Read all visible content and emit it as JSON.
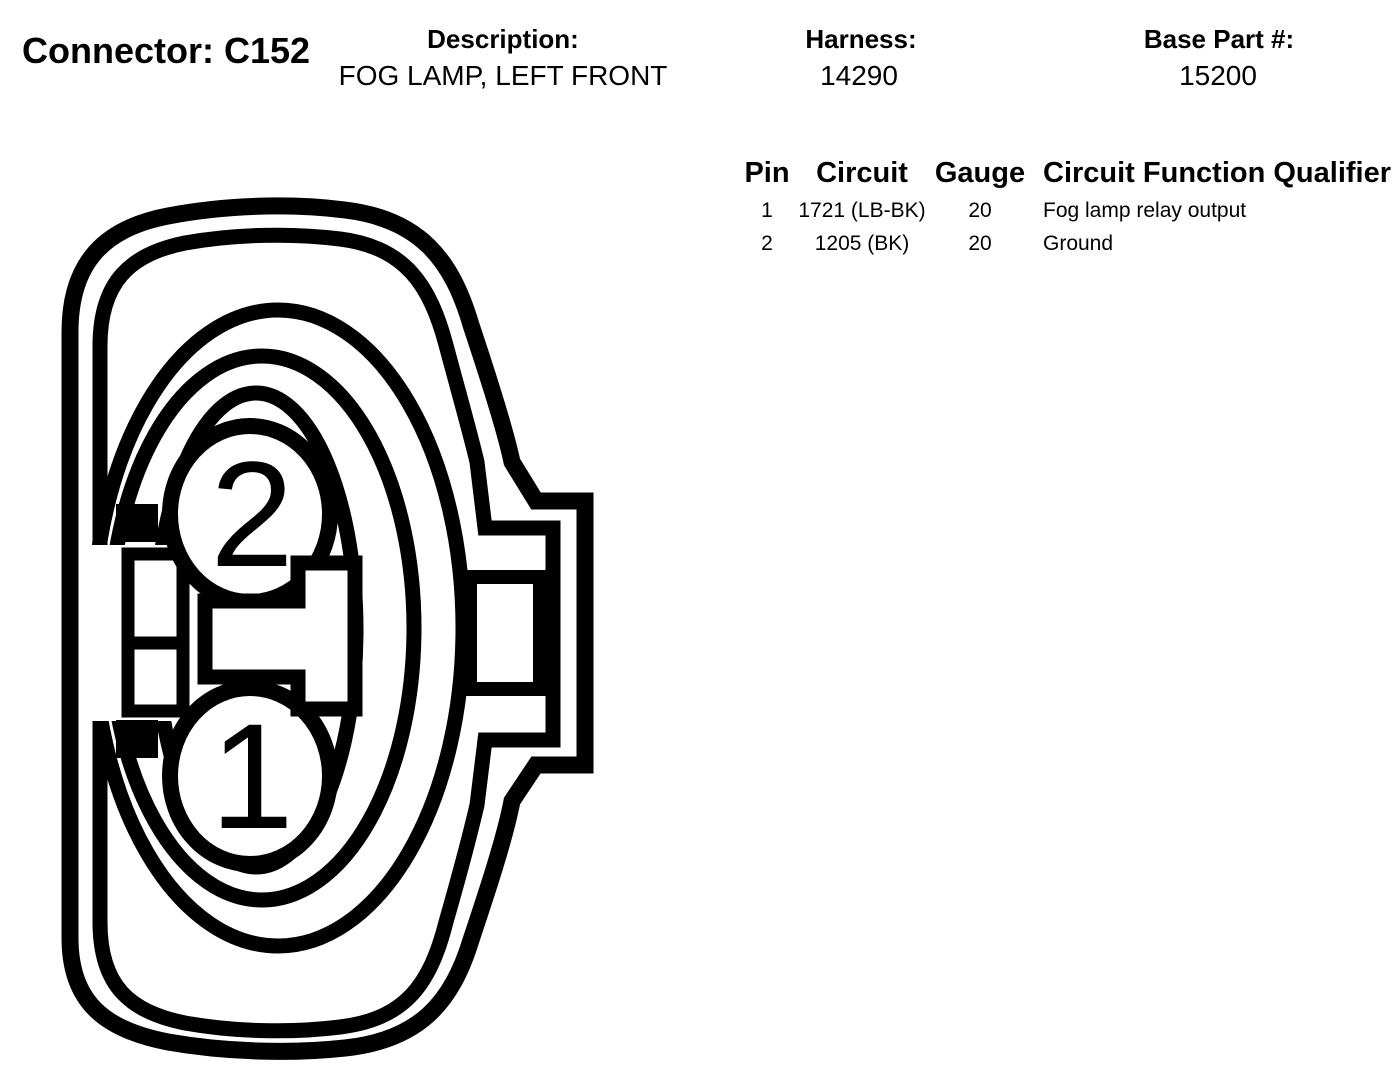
{
  "header": {
    "connector_label": "Connector: C152",
    "description_label": "Description:",
    "description_value": "FOG LAMP, LEFT FRONT",
    "harness_label": "Harness:",
    "harness_value": "14290",
    "base_part_label": "Base Part #:",
    "base_part_value": "15200"
  },
  "pin_table": {
    "headers": {
      "pin": "Pin",
      "circuit": "Circuit",
      "gauge": "Gauge",
      "qualifier": "Circuit Function Qualifier"
    },
    "rows": [
      {
        "pin": "1",
        "circuit": "1721 (LB-BK)",
        "gauge": "20",
        "qualifier": "Fog lamp relay output"
      },
      {
        "pin": "2",
        "circuit": "1205 (BK)",
        "gauge": "20",
        "qualifier": "Ground"
      }
    ]
  },
  "diagram": {
    "pin_top_label": "2",
    "pin_bottom_label": "1",
    "line_color": "#000000"
  }
}
